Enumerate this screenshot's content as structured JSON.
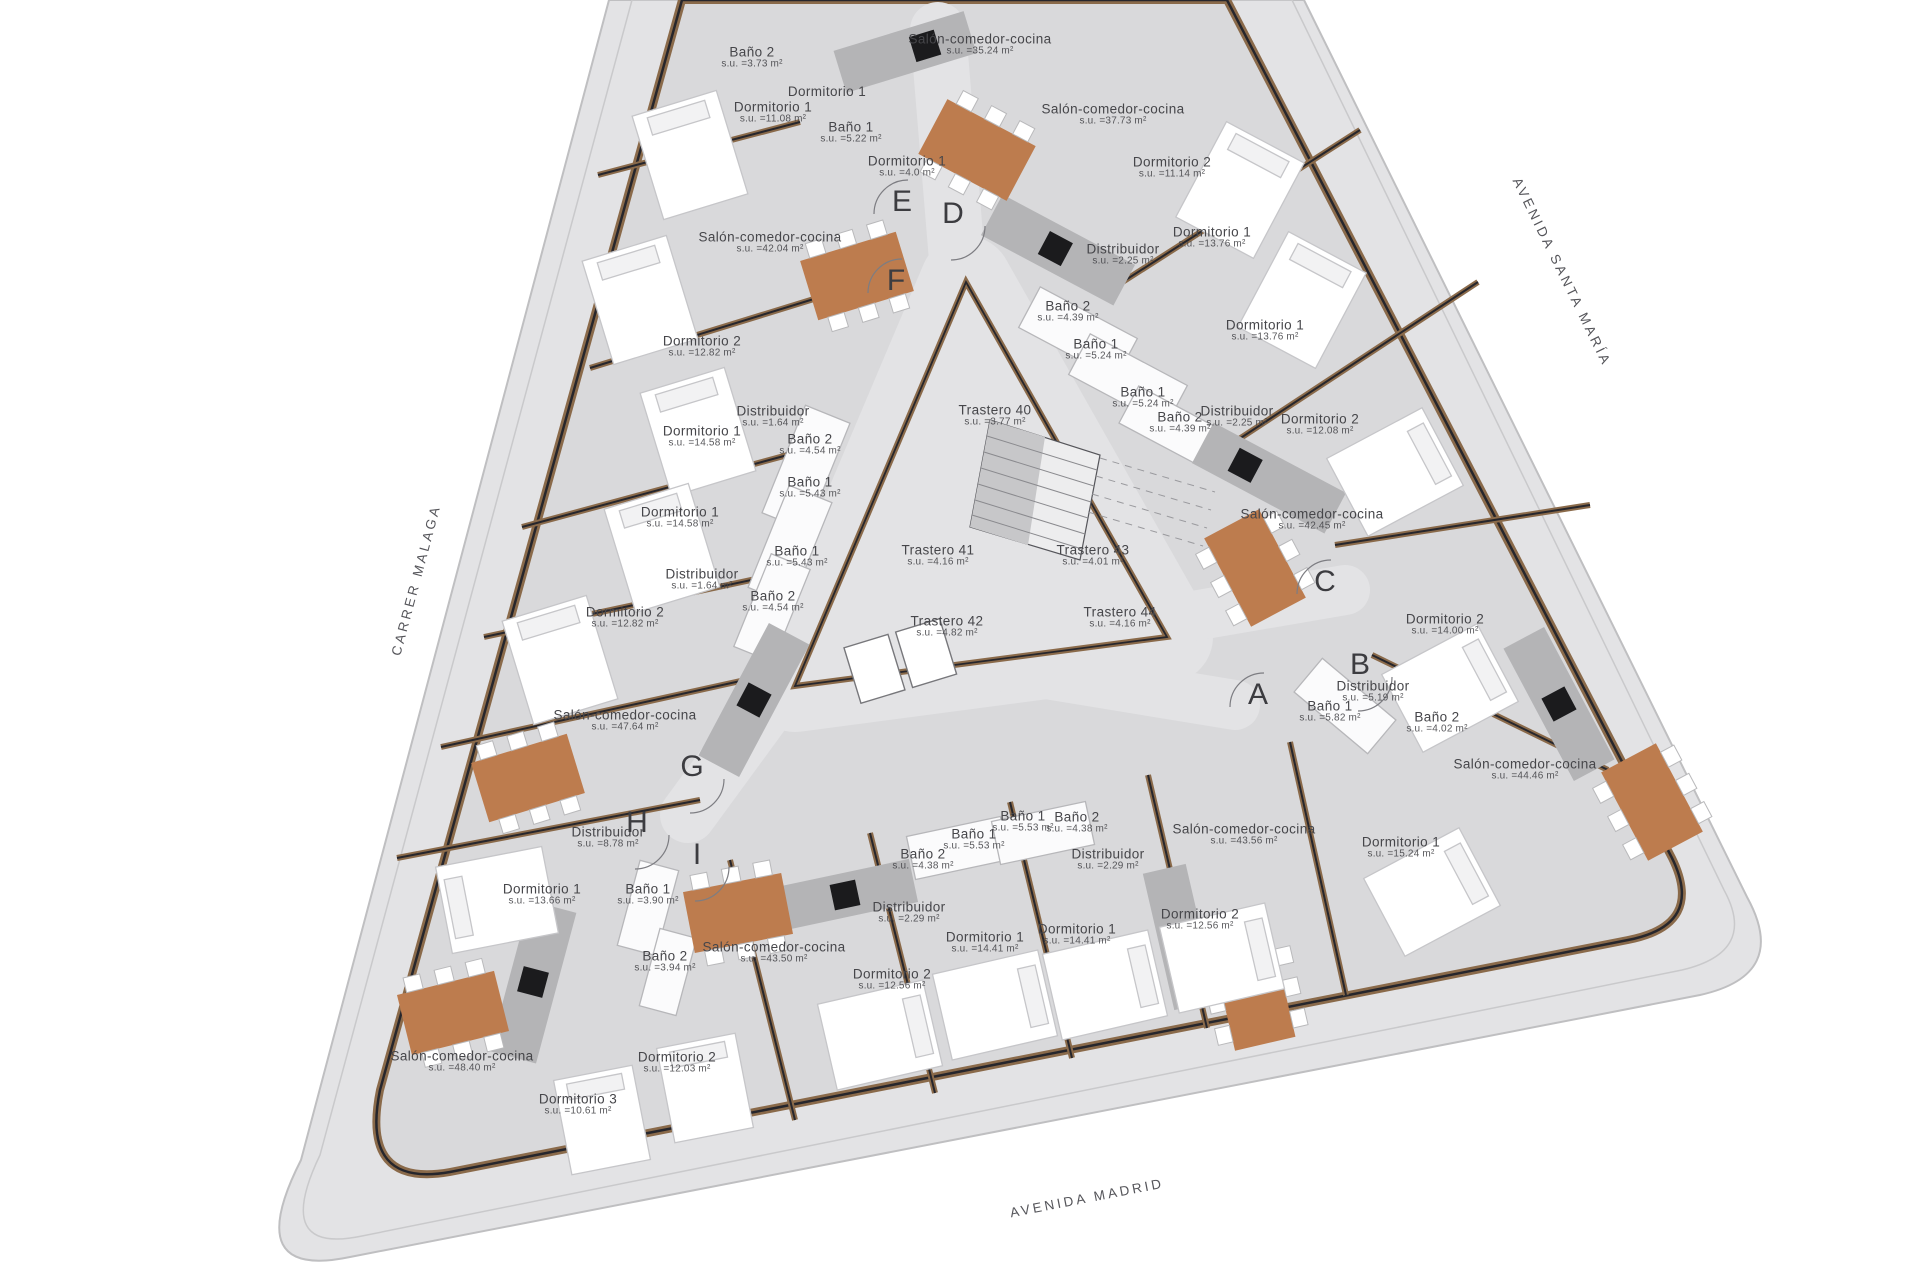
{
  "plan": {
    "type": "architectural-floor-plan",
    "area_prefix": "s.u. =",
    "area_suffix": " m²"
  },
  "streets": [
    {
      "name": "CARRER MALAGA",
      "x": 416,
      "y": 580,
      "rot": -75
    },
    {
      "name": "AVENIDA SANTA MARÍA",
      "x": 1562,
      "y": 272,
      "rot": 64
    },
    {
      "name": "AVENIDA MADRID",
      "x": 1087,
      "y": 1198,
      "rot": -11
    }
  ],
  "entrances": [
    {
      "label": "E",
      "x": 902,
      "y": 202
    },
    {
      "label": "D",
      "x": 953,
      "y": 214
    },
    {
      "label": "F",
      "x": 896,
      "y": 281
    },
    {
      "label": "C",
      "x": 1325,
      "y": 582
    },
    {
      "label": "B",
      "x": 1360,
      "y": 665
    },
    {
      "label": "A",
      "x": 1258,
      "y": 695
    },
    {
      "label": "G",
      "x": 692,
      "y": 767
    },
    {
      "label": "H",
      "x": 637,
      "y": 823
    },
    {
      "label": "I",
      "x": 697,
      "y": 855
    }
  ],
  "rooms": [
    {
      "name": "Baño 2",
      "area": "3.73",
      "x": 752,
      "y": 58
    },
    {
      "name": "Dormitorio 1",
      "area": "",
      "x": 827,
      "y": 92
    },
    {
      "name": "Dormitorio 1",
      "area": "11.08",
      "x": 773,
      "y": 113
    },
    {
      "name": "Baño 1",
      "area": "5.22",
      "x": 851,
      "y": 133
    },
    {
      "name": "Dormitorio 1",
      "area": "4.0",
      "x": 907,
      "y": 167
    },
    {
      "name": "Salón-comedor-cocina",
      "area": "35.24",
      "x": 980,
      "y": 45
    },
    {
      "name": "Salón-comedor-cocina",
      "area": "42.04",
      "x": 770,
      "y": 243
    },
    {
      "name": "Dormitorio 2",
      "area": "12.82",
      "x": 702,
      "y": 347
    },
    {
      "name": "Dormitorio 1",
      "area": "14.58",
      "x": 702,
      "y": 437
    },
    {
      "name": "Distribuidor",
      "area": "1.64",
      "x": 773,
      "y": 417
    },
    {
      "name": "Baño 2",
      "area": "4.54",
      "x": 810,
      "y": 445
    },
    {
      "name": "Baño 1",
      "area": "5.43",
      "x": 810,
      "y": 488
    },
    {
      "name": "Dormitorio 1",
      "area": "14.58",
      "x": 680,
      "y": 518
    },
    {
      "name": "Baño 1",
      "area": "5.43",
      "x": 797,
      "y": 557
    },
    {
      "name": "Distribuidor",
      "area": "1.64",
      "x": 702,
      "y": 580
    },
    {
      "name": "Baño 2",
      "area": "4.54",
      "x": 773,
      "y": 602
    },
    {
      "name": "Dormitorio 2",
      "area": "12.82",
      "x": 625,
      "y": 618
    },
    {
      "name": "Salón-comedor-cocina",
      "area": "47.64",
      "x": 625,
      "y": 721
    },
    {
      "name": "Salón-comedor-cocina",
      "area": "37.73",
      "x": 1113,
      "y": 115
    },
    {
      "name": "Dormitorio 2",
      "area": "11.14",
      "x": 1172,
      "y": 168
    },
    {
      "name": "Dormitorio 1",
      "area": "13.76",
      "x": 1212,
      "y": 238
    },
    {
      "name": "Distribuidor",
      "area": "2.25",
      "x": 1123,
      "y": 255
    },
    {
      "name": "Baño 2",
      "area": "4.39",
      "x": 1068,
      "y": 312
    },
    {
      "name": "Baño 1",
      "area": "5.24",
      "x": 1096,
      "y": 350
    },
    {
      "name": "Dormitorio 1",
      "area": "13.76",
      "x": 1265,
      "y": 331
    },
    {
      "name": "Baño 1",
      "area": "5.24",
      "x": 1143,
      "y": 398
    },
    {
      "name": "Baño 2",
      "area": "4.39",
      "x": 1180,
      "y": 423
    },
    {
      "name": "Distribuidor",
      "area": "2.25",
      "x": 1237,
      "y": 417
    },
    {
      "name": "Dormitorio 2",
      "area": "12.08",
      "x": 1320,
      "y": 425
    },
    {
      "name": "Salón-comedor-cocina",
      "area": "42.45",
      "x": 1312,
      "y": 520
    },
    {
      "name": "Trastero 40",
      "area": "3.77",
      "x": 995,
      "y": 416
    },
    {
      "name": "Trastero 41",
      "area": "4.16",
      "x": 938,
      "y": 556
    },
    {
      "name": "Trastero 43",
      "area": "4.01",
      "x": 1093,
      "y": 556
    },
    {
      "name": "Trastero 42",
      "area": "4.82",
      "x": 947,
      "y": 627
    },
    {
      "name": "Trastero 44",
      "area": "4.16",
      "x": 1120,
      "y": 618
    },
    {
      "name": "Dormitorio 2",
      "area": "14.00",
      "x": 1445,
      "y": 625
    },
    {
      "name": "Distribuidor",
      "area": "5.19",
      "x": 1373,
      "y": 692
    },
    {
      "name": "Baño 1",
      "area": "5.82",
      "x": 1330,
      "y": 712
    },
    {
      "name": "Baño 2",
      "area": "4.02",
      "x": 1437,
      "y": 723
    },
    {
      "name": "Salón-comedor-cocina",
      "area": "44.46",
      "x": 1525,
      "y": 770
    },
    {
      "name": "Dormitorio 1",
      "area": "15.24",
      "x": 1401,
      "y": 848
    },
    {
      "name": "Salón-comedor-cocina",
      "area": "43.50",
      "x": 774,
      "y": 953
    },
    {
      "name": "Dormitorio 2",
      "area": "12.56",
      "x": 892,
      "y": 980
    },
    {
      "name": "Distribuidor",
      "area": "2.29",
      "x": 909,
      "y": 913
    },
    {
      "name": "Baño 2",
      "area": "4.38",
      "x": 923,
      "y": 860
    },
    {
      "name": "Baño 1",
      "area": "5.53",
      "x": 974,
      "y": 840
    },
    {
      "name": "Baño 1",
      "area": "5.53",
      "x": 1023,
      "y": 822
    },
    {
      "name": "Baño 2",
      "area": "4.38",
      "x": 1077,
      "y": 823
    },
    {
      "name": "Dormitorio 1",
      "area": "14.41",
      "x": 985,
      "y": 943
    },
    {
      "name": "Dormitorio 1",
      "area": "14.41",
      "x": 1077,
      "y": 935
    },
    {
      "name": "Distribuidor",
      "area": "2.29",
      "x": 1108,
      "y": 860
    },
    {
      "name": "Dormitorio 2",
      "area": "12.56",
      "x": 1200,
      "y": 920
    },
    {
      "name": "Salón-comedor-cocina",
      "area": "43.56",
      "x": 1244,
      "y": 835
    },
    {
      "name": "Distribuidor",
      "area": "8.78",
      "x": 608,
      "y": 838
    },
    {
      "name": "Dormitorio 1",
      "area": "13.66",
      "x": 542,
      "y": 895
    },
    {
      "name": "Baño 1",
      "area": "3.90",
      "x": 648,
      "y": 895
    },
    {
      "name": "Baño 2",
      "area": "3.94",
      "x": 665,
      "y": 962
    },
    {
      "name": "Salón-comedor-cocina",
      "area": "48.40",
      "x": 462,
      "y": 1062
    },
    {
      "name": "Dormitorio 2",
      "area": "12.03",
      "x": 677,
      "y": 1063
    },
    {
      "name": "Dormitorio 3",
      "area": "10.61",
      "x": 578,
      "y": 1105
    }
  ],
  "colors": {
    "sidewalk": "#e3e3e5",
    "building_floor": "#d9d9db",
    "facade_wall": "#26262c",
    "wood_trim": "#8a6a4a",
    "dining_table": "#bd7c4e",
    "kitchen_island": "#b4b4b6",
    "stove": "#1b1b1d",
    "label_text": "#46464a"
  }
}
